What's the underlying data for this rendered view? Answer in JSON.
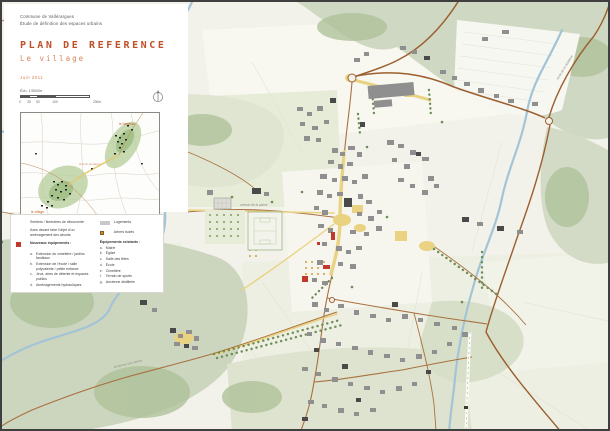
{
  "header": {
    "line1": "Commune de Vallérargues",
    "line2": "Étude de définition des espaces urbains"
  },
  "title": {
    "main": "PLAN DE REFERENCE",
    "subtitle": "Le village",
    "date": "Juin 2011"
  },
  "scale": {
    "label": "Éch. 1/5000e",
    "tick0": "0",
    "tick1": "25",
    "tick2": "50",
    "tick3": "100",
    "tick_end": "200m"
  },
  "inset": {
    "labels": {
      "hameau": "le hameau",
      "village": "le village",
      "liaison": "chemin de liaison"
    },
    "caption1": {
      "lead": "Plan de situation :",
      "text": " le village et le hameau de la distillerie"
    },
    "caption2": {
      "lead": "En jaune,",
      "text": " le parcours piétonnier reliant les deux entités"
    }
  },
  "legend": {
    "left1": "Sentiers / itinéraires de découverte",
    "left2": "Axes devant faire l'objet d'un aménagement des abords",
    "new_equip": {
      "title": "Nouveaux équipements :",
      "items": [
        {
          "key": "a.",
          "label": "Extension du cimetière / jardins familiaux"
        },
        {
          "key": "b.",
          "label": "Extension de l'école / salle polyvalente / petite enfance"
        },
        {
          "key": "c.",
          "label": "Jeux, aires de détente et espaces publics"
        },
        {
          "key": "d.",
          "label": "Aménagements hydrauliques"
        }
      ]
    },
    "housing": "Logements",
    "trees": "Arbres isolés",
    "existing": {
      "title": "Équipements existants :",
      "items": [
        {
          "key": "a.",
          "label": "Mairie"
        },
        {
          "key": "b.",
          "label": "Église"
        },
        {
          "key": "c.",
          "label": "Salle des fêtes"
        },
        {
          "key": "d.",
          "label": "École"
        },
        {
          "key": "e.",
          "label": "Cimetière"
        },
        {
          "key": "f.",
          "label": "Terrain de sports"
        },
        {
          "key": "g.",
          "label": "Ancienne distillerie"
        }
      ]
    }
  },
  "map_labels": {
    "road1": "route de la distillerie",
    "road2": "chemin de la plaine",
    "road3": "ancienne voie ferrée"
  },
  "colors": {
    "accent": "#c14f28",
    "path_yellow": "#e9d382",
    "woodland": "#cfd8c2",
    "new_red": "#c0392b",
    "river_blue": "#a3c4d6"
  }
}
